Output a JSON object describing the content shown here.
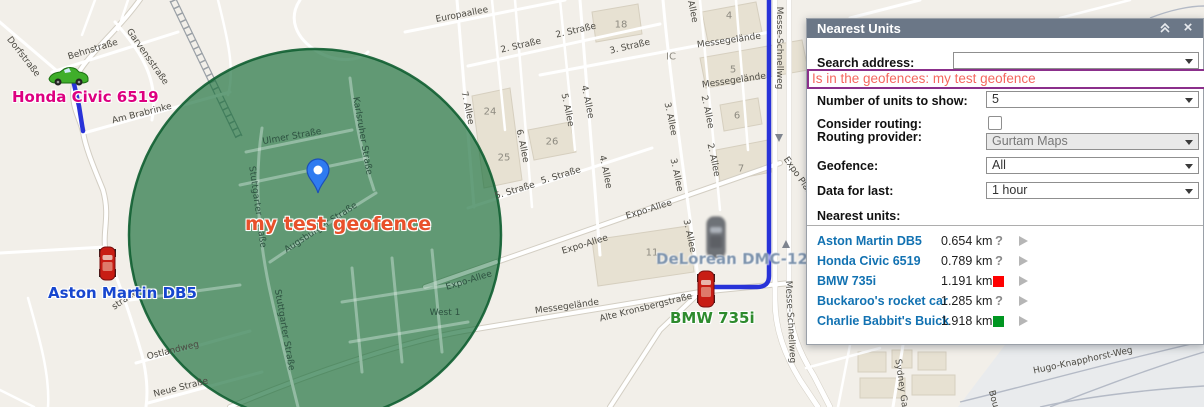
{
  "panel": {
    "title": "Nearest Units",
    "icons": {
      "collapse": "double-chevron-up",
      "close": "×"
    },
    "fields": {
      "search_address": {
        "label": "Search address:",
        "value": ""
      },
      "geofence_filter": {
        "value": "Is in the geofences: my test geofence"
      },
      "units_to_show": {
        "label": "Number of units to show:",
        "value": "5"
      },
      "consider_routing": {
        "label": "Consider routing:",
        "checked": false
      },
      "routing_provider": {
        "label": "Routing provider:",
        "value": "Gurtam Maps"
      },
      "geofence": {
        "label": "Geofence:",
        "value": "All"
      },
      "data_for_last": {
        "label": "Data for last:",
        "value": "1 hour"
      }
    },
    "nearest_units_label": "Nearest units:",
    "units": [
      {
        "name": "Aston Martin DB5",
        "distance": "0.654 km",
        "status": "unknown"
      },
      {
        "name": "Honda Civic 6519",
        "distance": "0.789 km",
        "status": "unknown"
      },
      {
        "name": "BMW 735i",
        "distance": "1.191 km",
        "status": "red"
      },
      {
        "name": "Buckaroo's rocket car",
        "distance": "1.285 km",
        "status": "unknown"
      },
      {
        "name": "Charlie Babbit's Buick",
        "distance": "1.918 km",
        "status": "green"
      }
    ],
    "colors": {
      "header_bg": "#6b7787",
      "unit_name": "#1272b2",
      "status_red": "#ff0000",
      "status_green": "#009621",
      "highlight_border": "#8b2f8b",
      "highlight_text": "#f4675f"
    }
  },
  "map": {
    "geofence_name": "my test geofence",
    "geofence_label_color": "#e8512b",
    "geofence_fill": "#166c37",
    "route_color": "#2832d8",
    "vehicles": [
      {
        "id": "honda",
        "name": "Honda Civic 6519",
        "label_color": "#dd0080",
        "x": 12,
        "y": 88,
        "blurred": false
      },
      {
        "id": "aston",
        "name": "Aston Martin DB5",
        "label_color": "#1746cf",
        "x": 48,
        "y": 284,
        "blurred": false
      },
      {
        "id": "bmw",
        "name": "BMW 735i",
        "label_color": "#2e8b2e",
        "x": 670,
        "y": 309,
        "blurred": false
      },
      {
        "id": "delorean",
        "name": "DeLorean DMC-12",
        "label_color": "#7d93ad",
        "x": 656,
        "y": 250,
        "blurred": true
      }
    ],
    "street_labels": [
      {
        "t": "Dorfstraße",
        "x": 23,
        "y": 57,
        "r": 52
      },
      {
        "t": "Behnstraße",
        "x": 93,
        "y": 50,
        "r": -17
      },
      {
        "t": "Garvensstraße",
        "x": 147,
        "y": 57,
        "r": 55
      },
      {
        "t": "Am Brabrinke",
        "x": 142,
        "y": 114,
        "r": -14
      },
      {
        "t": "Europaallee",
        "x": 462,
        "y": 15,
        "r": -11
      },
      {
        "t": "2. Straße",
        "x": 521,
        "y": 46,
        "r": -13
      },
      {
        "t": "2. Straße",
        "x": 576,
        "y": 31,
        "r": -13
      },
      {
        "t": "3. Straße",
        "x": 630,
        "y": 47,
        "r": -13
      },
      {
        "t": "5. Straße",
        "x": 515,
        "y": 191,
        "r": -17
      },
      {
        "t": "5. Straße",
        "x": 561,
        "y": 176,
        "r": -17
      },
      {
        "t": "Expo-Allee",
        "x": 649,
        "y": 210,
        "r": -17
      },
      {
        "t": "Expo-Allee",
        "x": 585,
        "y": 245,
        "r": -17
      },
      {
        "t": "Expo-Allee",
        "x": 469,
        "y": 281,
        "r": -17,
        "c": "green"
      },
      {
        "t": "7. Allee",
        "x": 467,
        "y": 108,
        "r": 78
      },
      {
        "t": "6. Allee",
        "x": 522,
        "y": 146,
        "r": 78
      },
      {
        "t": "5. Allee",
        "x": 567,
        "y": 110,
        "r": 78
      },
      {
        "t": "4. Allee",
        "x": 587,
        "y": 102,
        "r": 78
      },
      {
        "t": "4. Allee",
        "x": 605,
        "y": 172,
        "r": 78
      },
      {
        "t": "3. Allee",
        "x": 670,
        "y": 119,
        "r": 78
      },
      {
        "t": "3. Allee",
        "x": 676,
        "y": 175,
        "r": 78
      },
      {
        "t": "3. Allee",
        "x": 689,
        "y": 236,
        "r": 78
      },
      {
        "t": "2. Allee",
        "x": 707,
        "y": 112,
        "r": 78
      },
      {
        "t": "2. Allee",
        "x": 713,
        "y": 160,
        "r": 78
      },
      {
        "t": "1. Allee",
        "x": 691,
        "y": 6,
        "r": 78
      },
      {
        "t": "18",
        "x": 621,
        "y": 25,
        "c": "bldg"
      },
      {
        "t": "24",
        "x": 490,
        "y": 112,
        "c": "bldg"
      },
      {
        "t": "25",
        "x": 504,
        "y": 158,
        "c": "bldg"
      },
      {
        "t": "26",
        "x": 552,
        "y": 142,
        "c": "bldg"
      },
      {
        "t": "11",
        "x": 652,
        "y": 253,
        "c": "bldg"
      },
      {
        "t": "4",
        "x": 729,
        "y": 16,
        "c": "bldg"
      },
      {
        "t": "5",
        "x": 733,
        "y": 70,
        "c": "bldg"
      },
      {
        "t": "6",
        "x": 737,
        "y": 116,
        "c": "bldg"
      },
      {
        "t": "7",
        "x": 741,
        "y": 169,
        "c": "bldg"
      },
      {
        "t": "IC",
        "x": 671,
        "y": 57,
        "c": "bldg"
      },
      {
        "t": "Messegelände",
        "x": 729,
        "y": 41,
        "r": -8
      },
      {
        "t": "Messegelände",
        "x": 734,
        "y": 81,
        "r": -8
      },
      {
        "t": "Messegelände",
        "x": 567,
        "y": 307,
        "r": -8
      },
      {
        "t": "Messe-Schnellweg",
        "x": 779,
        "y": 48,
        "r": 90
      },
      {
        "t": "Messe-Schnellweg",
        "x": 790,
        "y": 322,
        "r": 87
      },
      {
        "t": "Expo Plaza",
        "x": 799,
        "y": 178,
        "r": 55
      },
      {
        "t": "Alte Kronsbergstraße",
        "x": 646,
        "y": 308,
        "r": -14
      },
      {
        "t": "West 1",
        "x": 445,
        "y": 313,
        "c": "green"
      },
      {
        "t": "Ulmer Straße",
        "x": 292,
        "y": 137,
        "r": -10,
        "c": "green"
      },
      {
        "t": "Karlsruher Straße",
        "x": 362,
        "y": 136,
        "r": 80,
        "c": "green"
      },
      {
        "t": "Stuttgarter Straße",
        "x": 257,
        "y": 207,
        "r": 82,
        "c": "green"
      },
      {
        "t": "Stuttgarter Straße",
        "x": 284,
        "y": 330,
        "r": 80,
        "c": "green"
      },
      {
        "t": "Augsburger Straße",
        "x": 321,
        "y": 228,
        "r": -33,
        "c": "green"
      },
      {
        "t": "Ostlandweg",
        "x": 173,
        "y": 351,
        "r": -14
      },
      {
        "t": "Neue Straße",
        "x": 181,
        "y": 388,
        "r": -14
      },
      {
        "t": "straße",
        "x": 125,
        "y": 300,
        "r": -35
      },
      {
        "t": "Hugo-Knapphorst-Weg",
        "x": 1083,
        "y": 361,
        "r": -12
      },
      {
        "t": "Sydney Gar",
        "x": 901,
        "y": 385,
        "r": 82
      },
      {
        "t": "Bou",
        "x": 993,
        "y": 399,
        "r": 75
      }
    ]
  }
}
